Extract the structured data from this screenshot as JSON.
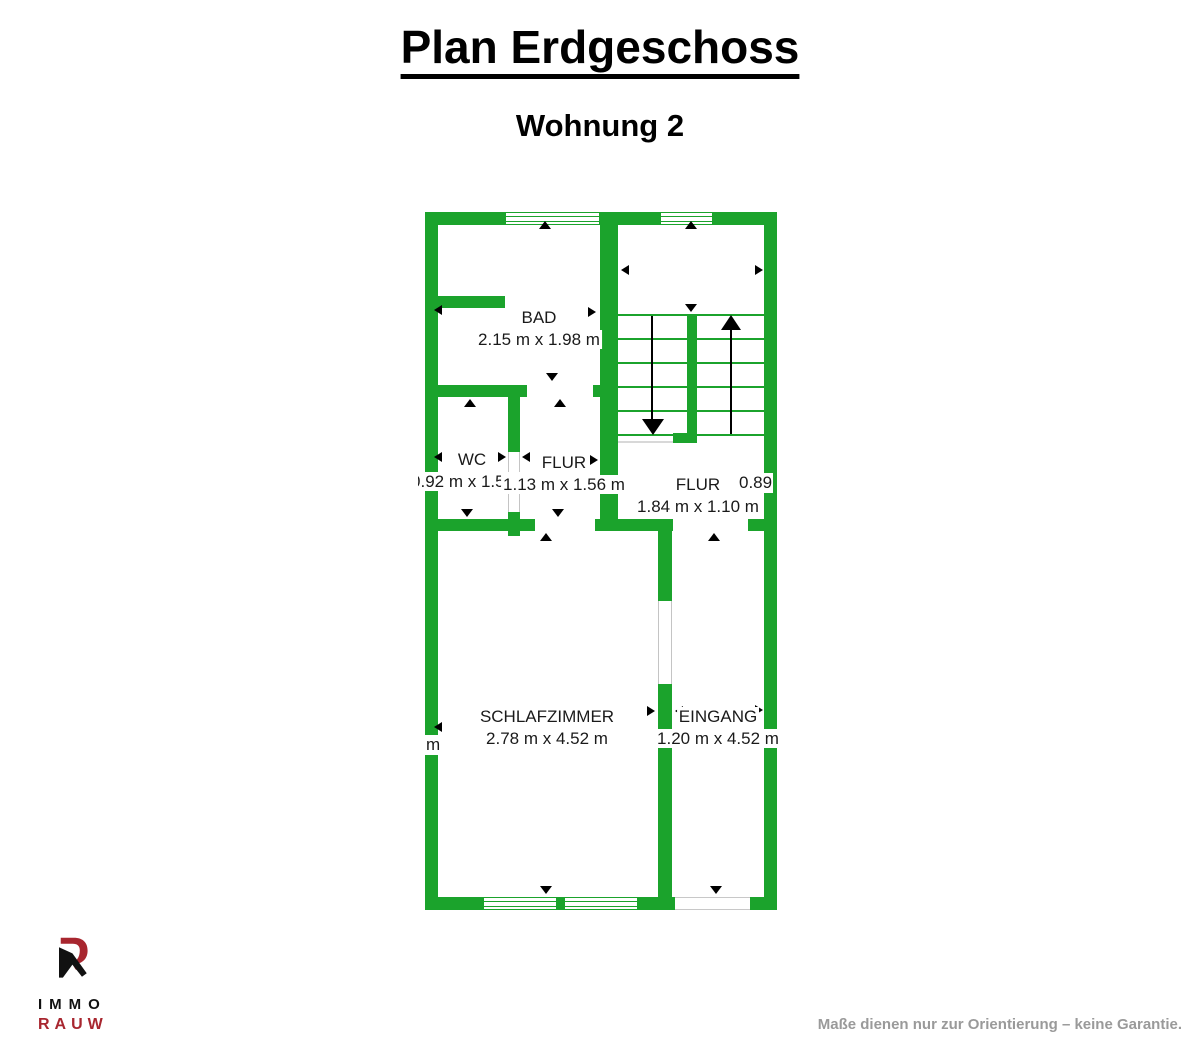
{
  "title": "Plan Erdgeschoss",
  "subtitle": "Wohnung 2",
  "rooms": [
    {
      "name": "BAD",
      "dims": "2.15 m x 1.98 m"
    },
    {
      "name": "WC",
      "dims": "0.92 m x 1.56 m"
    },
    {
      "name": "FLUR",
      "dims": "1.13 m x 1.56 m"
    },
    {
      "name": "FLUR",
      "dims": "1.84 m x 1.10 m"
    },
    {
      "name": "SCHLAFZIMMER",
      "dims": "2.78 m x 4.52 m"
    },
    {
      "name": "EINGANG",
      "dims": "1.20 m x 4.52 m"
    }
  ],
  "fragments": {
    "left_clipped_text": "m",
    "right_clipped_text": "0.89"
  },
  "logo": {
    "line1": "IMMO",
    "line2": "RAUW"
  },
  "footer": "Maße dienen nur zur Orientierung – keine Garantie.",
  "colors": {
    "wall": "#1BA32C",
    "logo_red": "#A8262F",
    "footer_gray": "#9A9A9A"
  }
}
